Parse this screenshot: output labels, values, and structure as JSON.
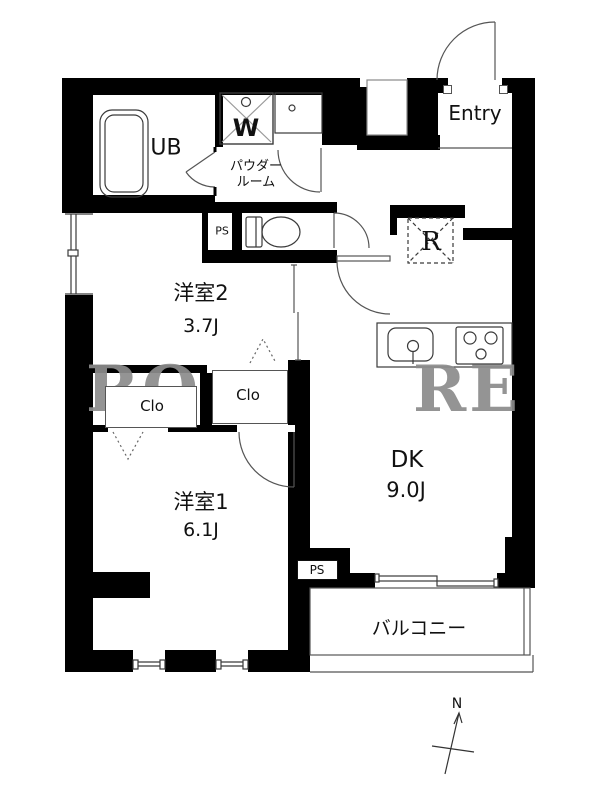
{
  "plan_title": "2DK apartment floor plan",
  "rooms": {
    "ub": "UB",
    "powder_line1": "パウダー",
    "powder_line2": "ルーム",
    "entry": "Entry",
    "room2_name": "洋室2",
    "room2_size": "3.7J",
    "room1_name": "洋室1",
    "room1_size": "6.1J",
    "dk_name": "DK",
    "dk_size": "9.0J",
    "balcony": "バルコニー"
  },
  "closets": {
    "clo1": "Clo",
    "clo2": "Clo"
  },
  "utilities": {
    "ps_toilet": "PS",
    "ps_dk": "PS",
    "washer_symbol": "W",
    "fridge_symbol": "R"
  },
  "compass": {
    "north_label": "N"
  },
  "watermark": {
    "left": "RO",
    "right": "RE"
  },
  "colors": {
    "wall": "#000000",
    "line": "#3a3a3a",
    "watermark": "#8c8c8c",
    "background": "#ffffff"
  }
}
